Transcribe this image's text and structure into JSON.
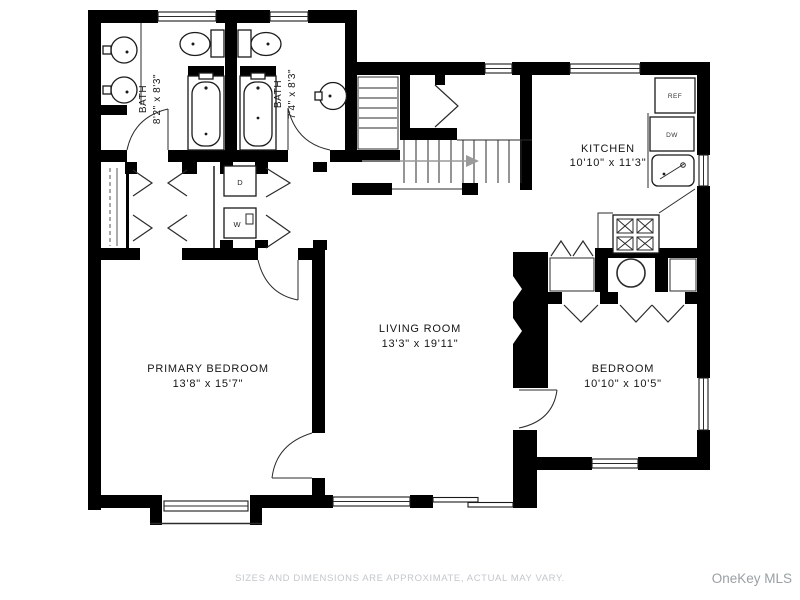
{
  "plan": {
    "rooms": [
      {
        "id": "bath-1",
        "name": "BATH",
        "dims": "8'2\" x 8'3\""
      },
      {
        "id": "bath-2",
        "name": "BATH",
        "dims": "7'4\" x 8'3\""
      },
      {
        "id": "kitchen",
        "name": "KITCHEN",
        "dims": "10'10\" x 11'3\""
      },
      {
        "id": "living-room",
        "name": "LIVING ROOM",
        "dims": "13'3\" x 19'11\""
      },
      {
        "id": "primary-bedroom",
        "name": "PRIMARY BEDROOM",
        "dims": "13'8\" x 15'7\""
      },
      {
        "id": "bedroom",
        "name": "BEDROOM",
        "dims": "10'10\" x 10'5\""
      }
    ],
    "fixtures": {
      "refrigerator": "REF",
      "dishwasher": "DW",
      "dryer": "D",
      "washer": "W"
    }
  },
  "footer": {
    "disclaimer": "SIZES AND DIMENSIONS ARE APPROXIMATE, ACTUAL MAY VARY."
  },
  "watermark": {
    "label": "OneKey MLS"
  },
  "colors": {
    "background": "#ffffff",
    "wall": "#000000",
    "fixture_line": "#1a1a1a",
    "label_text": "#161616",
    "disclaimer_text": "#c3c7cc",
    "watermark_text": "#9aa0a4"
  }
}
